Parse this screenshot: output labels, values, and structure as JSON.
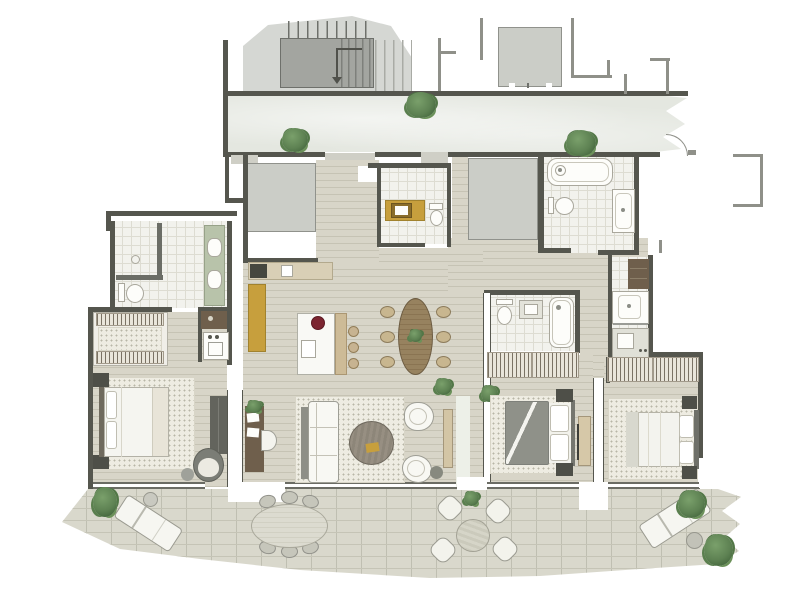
{
  "canvas": {
    "width": 800,
    "height": 600,
    "background": "#ffffff",
    "kind": "rendered residential floor plan, no text labels"
  },
  "palette": {
    "canvasBg": "#ffffff",
    "wall": "#55564e",
    "wallLight": "#8f9089",
    "corridorFloor": "#e4e7e0",
    "woodFloor": "#d8d5c8",
    "woodLine": "#c6c3b4",
    "tileFloor": "#f2f2ed",
    "tileLine": "#dddcd2",
    "terraceFloor": "#d9d8cc",
    "terraceLine": "#c5c4b6",
    "serviceBox": "#cbcdc7",
    "stairLight": "#d5d7d3",
    "stairDark": "#a3a5a0",
    "rug": "#eeece2",
    "rugDot": "#b8b6a7",
    "furnitureWhite": "#f8f8f3",
    "furnitureOutline": "#9e9e95",
    "woodLight": "#d9cfb6",
    "woodMedium": "#c0a87f",
    "woodDark": "#6f5f4c",
    "gold": "#c79f3d",
    "goldDark": "#8a6d2a",
    "sage": "#b8c3aa",
    "hatchBg": "#e9e5da",
    "hatchStroke": "#7a7264",
    "plantGreen": "#5d8152",
    "plantGreenDark": "#3f6239",
    "duvetGray": "#8f9189",
    "chairGray": "#7b7d76",
    "accentRed": "#7c2530",
    "paleBand": "#edf0e8",
    "matGray": "#cfcfc6"
  },
  "rooms": [
    "stairwell",
    "elevator-shaft",
    "shared-corridor",
    "entry-hall",
    "powder-room",
    "service-shaft-1",
    "service-shaft-2",
    "guest-bathroom",
    "kitchen",
    "dining-area",
    "living-room",
    "master-bathroom",
    "walk-in-closet",
    "laundry",
    "master-bedroom",
    "bedroom-2",
    "ensuite-bathroom",
    "shower-room",
    "bedroom-3",
    "wardrobes",
    "terrace"
  ],
  "furniture": [
    "double-bed x3",
    "sofa",
    "coffee-table",
    "armchair x2",
    "desk",
    "desk-chair",
    "swivel-chair",
    "kitchen-island",
    "bar-stool x3",
    "dining-table-oval",
    "dining-chair x6",
    "toilet x4",
    "bathtub x2",
    "shower x3",
    "washbasin x6",
    "washing-machine",
    "tv-console x2",
    "sun-lounger x2",
    "outdoor-oval-table",
    "outdoor-chair x6",
    "bistro-table",
    "bistro-chair x4",
    "potted-plant x12"
  ]
}
